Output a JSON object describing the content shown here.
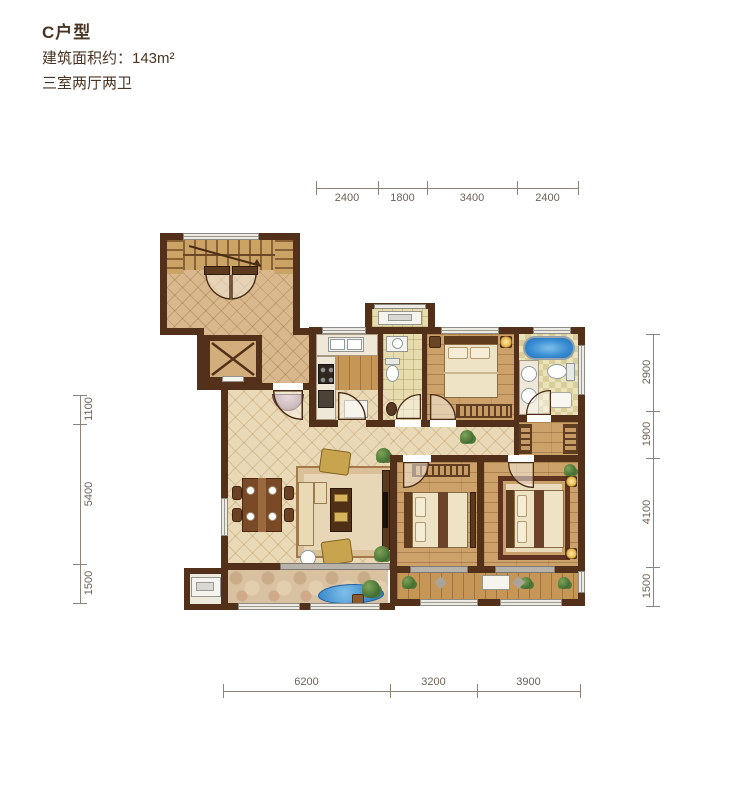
{
  "title": {
    "unit": "C户型",
    "area_label": "建筑面积约：143m²",
    "layout_label": "三室两厅两卫"
  },
  "dimensions": {
    "top": [
      "2400",
      "1800",
      "3400",
      "2400"
    ],
    "bottom": [
      "6200",
      "3200",
      "3900"
    ],
    "left": [
      "1100",
      "5400",
      "1500"
    ],
    "right": [
      "2900",
      "1900",
      "4100",
      "1500"
    ]
  },
  "colors": {
    "wall": "#533019",
    "wood_floor": "#c69657",
    "hall_floor": "#e9d9b6",
    "lobby_floor": "#d8b88c",
    "tile_floor": "#e7dcae",
    "bathtub_blue": "#2f7fc7",
    "water_blue": "#3d8ad2",
    "dimension_text": "#6e6156",
    "title_text": "#4a3423"
  }
}
